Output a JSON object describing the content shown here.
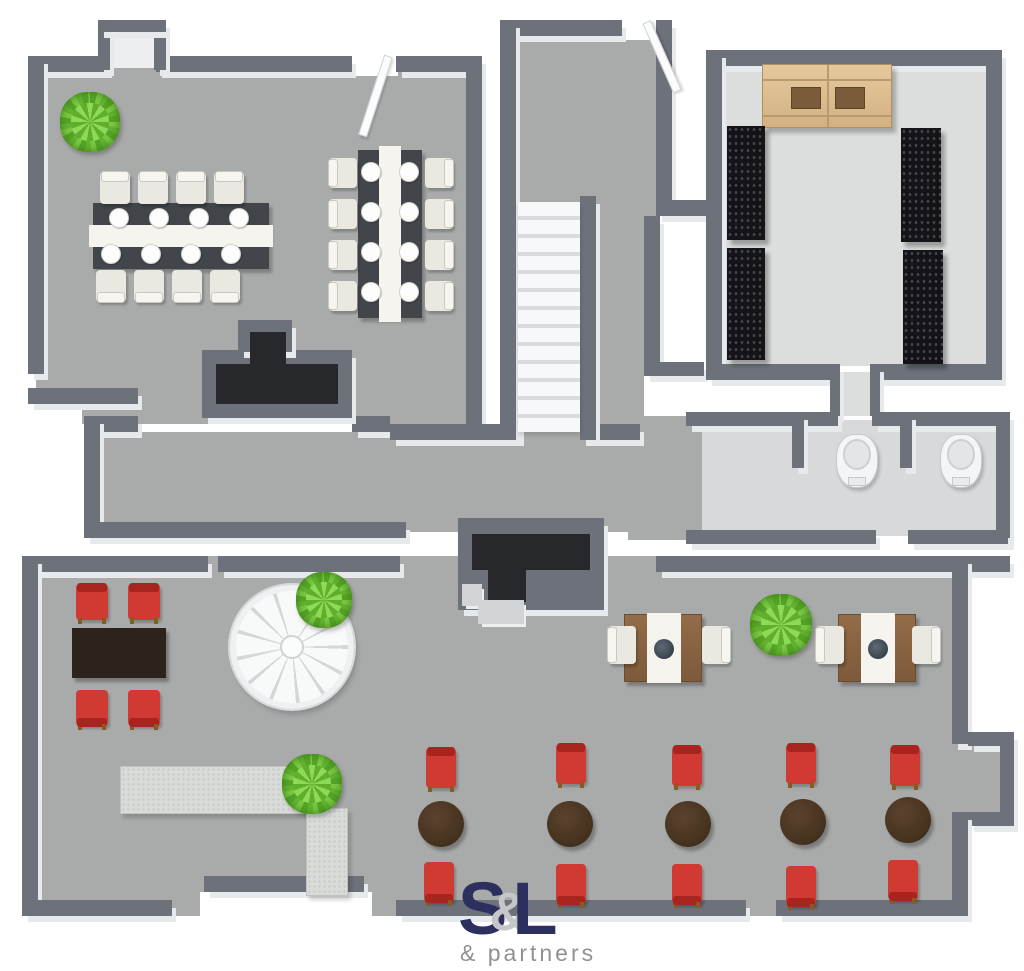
{
  "figure_type": "3d-floor-plan",
  "logo": {
    "letter_s": "S",
    "ampersand": "&",
    "letter_l": "L",
    "subtitle": "& partners"
  },
  "palette": {
    "wall": "#6c717a",
    "wall_side": "#e7eaec",
    "floor_main": "#a9abaa",
    "floor_storage": "#dcdedd",
    "floor_bath": "#d7d9da",
    "floor_alcove": "#eceeef",
    "accent_red": "#d03a32",
    "table_round_brown": "#46331f",
    "table_dark": "#2c231c",
    "wood": "#8b6544",
    "cabinet_wood": "#d9ba8c",
    "rack_black": "#141418",
    "plant_green": "#6dbf36",
    "stair_white": "#f7f8f9",
    "logo_navy": "#2d2f5e",
    "logo_gray": "#8f9193"
  },
  "rooms": [
    {
      "id": "banquet-room",
      "position": "top-left"
    },
    {
      "id": "entry-hall",
      "position": "top-middle"
    },
    {
      "id": "storage-room",
      "position": "top-right"
    },
    {
      "id": "bathrooms",
      "position": "middle-right",
      "toilet_count": 2
    },
    {
      "id": "corridor",
      "position": "middle"
    },
    {
      "id": "restaurant-hall",
      "position": "bottom"
    }
  ],
  "floors": [
    {
      "name": "banquet-room-floor",
      "g": [
        36,
        60,
        442,
        364
      ],
      "c": "#a9abaa"
    },
    {
      "name": "alcove-floor",
      "g": [
        110,
        32,
        44,
        36
      ],
      "c": "#eceeef"
    },
    {
      "name": "entry-hall-floor",
      "g": [
        516,
        28,
        140,
        190
      ],
      "c": "#a9abaa"
    },
    {
      "name": "stair-corridor-floor",
      "g": [
        596,
        196,
        48,
        232
      ],
      "c": "#a9abaa"
    },
    {
      "name": "storage-room-floor",
      "g": [
        714,
        64,
        274,
        302
      ],
      "c": "#dcdedd"
    },
    {
      "name": "storage-passage-floor",
      "g": [
        838,
        372,
        34,
        44
      ],
      "c": "#dcdedd"
    },
    {
      "name": "bathroom-floor",
      "g": [
        692,
        420,
        312,
        116
      ],
      "c": "#d7d9da"
    },
    {
      "name": "corridor-floor",
      "g": [
        92,
        432,
        548,
        100
      ],
      "c": "#a9abaa"
    },
    {
      "name": "link-floor",
      "g": [
        628,
        416,
        74,
        124
      ],
      "c": "#a9abaa"
    },
    {
      "name": "restaurant-hall-floor",
      "g": [
        24,
        556,
        944,
        360
      ],
      "c": "#a9abaa"
    },
    {
      "name": "bay-floor",
      "g": [
        952,
        746,
        48,
        66
      ],
      "c": "#a9abaa"
    }
  ],
  "walls": [
    [
      28,
      56,
      80,
      16
    ],
    [
      156,
      56,
      196,
      16
    ],
    [
      396,
      56,
      86,
      16
    ],
    [
      28,
      56,
      16,
      318
    ],
    [
      28,
      388,
      110,
      16
    ],
    [
      98,
      20,
      12,
      50
    ],
    [
      154,
      20,
      12,
      50
    ],
    [
      98,
      20,
      68,
      12
    ],
    [
      466,
      56,
      16,
      368
    ],
    [
      84,
      416,
      54,
      16
    ],
    [
      84,
      416,
      16,
      122
    ],
    [
      84,
      522,
      322,
      16
    ],
    [
      352,
      416,
      38,
      16
    ],
    [
      390,
      424,
      130,
      16
    ],
    [
      582,
      424,
      58,
      16
    ],
    [
      500,
      20,
      122,
      16
    ],
    [
      500,
      20,
      16,
      420
    ],
    [
      656,
      20,
      16,
      196
    ],
    [
      656,
      200,
      56,
      16
    ],
    [
      580,
      196,
      16,
      244
    ],
    [
      644,
      216,
      16,
      146
    ],
    [
      644,
      362,
      60,
      14
    ],
    [
      706,
      50,
      296,
      16
    ],
    [
      706,
      50,
      16,
      314
    ],
    [
      986,
      50,
      16,
      330
    ],
    [
      706,
      364,
      130,
      16
    ],
    [
      870,
      364,
      132,
      16
    ],
    [
      830,
      364,
      10,
      52
    ],
    [
      870,
      364,
      10,
      52
    ],
    [
      686,
      412,
      152,
      14
    ],
    [
      872,
      412,
      138,
      14
    ],
    [
      996,
      412,
      14,
      132
    ],
    [
      686,
      530,
      190,
      14
    ],
    [
      908,
      530,
      100,
      14
    ],
    [
      792,
      412,
      12,
      56
    ],
    [
      900,
      412,
      12,
      56
    ],
    [
      22,
      556,
      186,
      16
    ],
    [
      218,
      556,
      182,
      16
    ],
    [
      656,
      556,
      354,
      16
    ],
    [
      22,
      556,
      16,
      360
    ],
    [
      22,
      900,
      150,
      16
    ],
    [
      204,
      876,
      160,
      16
    ],
    [
      396,
      900,
      350,
      16
    ],
    [
      776,
      900,
      186,
      16
    ],
    [
      952,
      556,
      16,
      188
    ],
    [
      968,
      732,
      46,
      14
    ],
    [
      1000,
      732,
      14,
      94
    ],
    [
      968,
      812,
      46,
      14
    ],
    [
      952,
      812,
      16,
      104
    ]
  ],
  "white_patches": [
    [
      350,
      50,
      48,
      26
    ],
    [
      620,
      16,
      40,
      24
    ],
    [
      24,
      398,
      58,
      32
    ],
    [
      200,
      892,
      172,
      26
    ]
  ],
  "shafts": [
    {
      "name": "upper-shaft",
      "outer": [
        202,
        350,
        150,
        68
      ],
      "bump": [
        238,
        320,
        54,
        32
      ],
      "voids": [
        [
          250,
          332,
          36,
          46
        ],
        [
          216,
          364,
          122,
          40
        ]
      ],
      "stubs": []
    },
    {
      "name": "lower-shaft",
      "outer": [
        458,
        518,
        146,
        92
      ],
      "voids": [
        [
          472,
          534,
          118,
          36
        ],
        [
          488,
          570,
          38,
          32
        ]
      ],
      "stubs": [
        [
          462,
          584,
          20,
          22
        ],
        [
          478,
          600,
          46,
          24
        ]
      ]
    }
  ],
  "doors": [
    {
      "x": 384,
      "y": 56,
      "len": 84,
      "angle": 18
    },
    {
      "x": 642,
      "y": 22,
      "len": 76,
      "angle": -24
    }
  ],
  "staircase": {
    "g": [
      518,
      202,
      62,
      230
    ],
    "steps": 13
  },
  "spiral_staircase": {
    "cx": 292,
    "cy": 647,
    "r": 62
  },
  "furniture": [
    {
      "t": "banquet-h",
      "g": [
        93,
        203,
        176,
        66
      ],
      "plates_per_side": 4
    },
    {
      "t": "banquet-v",
      "g": [
        358,
        150,
        64,
        168
      ],
      "plates_per_side": 4
    },
    {
      "t": "chair",
      "kind": "white",
      "back": "top",
      "g": [
        100,
        172,
        30,
        32
      ]
    },
    {
      "t": "chair",
      "kind": "white",
      "back": "top",
      "g": [
        138,
        172,
        30,
        32
      ]
    },
    {
      "t": "chair",
      "kind": "white",
      "back": "top",
      "g": [
        176,
        172,
        30,
        32
      ]
    },
    {
      "t": "chair",
      "kind": "white",
      "back": "top",
      "g": [
        214,
        172,
        30,
        32
      ]
    },
    {
      "t": "chair",
      "kind": "white",
      "back": "bottom",
      "g": [
        96,
        270,
        30,
        32
      ]
    },
    {
      "t": "chair",
      "kind": "white",
      "back": "bottom",
      "g": [
        134,
        270,
        30,
        32
      ]
    },
    {
      "t": "chair",
      "kind": "white",
      "back": "bottom",
      "g": [
        172,
        270,
        30,
        32
      ]
    },
    {
      "t": "chair",
      "kind": "white",
      "back": "bottom",
      "g": [
        210,
        270,
        30,
        32
      ]
    },
    {
      "t": "chair",
      "kind": "white",
      "back": "left",
      "g": [
        329,
        158,
        28,
        30
      ]
    },
    {
      "t": "chair",
      "kind": "white",
      "back": "left",
      "g": [
        329,
        199,
        28,
        30
      ]
    },
    {
      "t": "chair",
      "kind": "white",
      "back": "left",
      "g": [
        329,
        240,
        28,
        30
      ]
    },
    {
      "t": "chair",
      "kind": "white",
      "back": "left",
      "g": [
        329,
        281,
        28,
        30
      ]
    },
    {
      "t": "chair",
      "kind": "white",
      "back": "right",
      "g": [
        425,
        158,
        28,
        30
      ]
    },
    {
      "t": "chair",
      "kind": "white",
      "back": "right",
      "g": [
        425,
        199,
        28,
        30
      ]
    },
    {
      "t": "chair",
      "kind": "white",
      "back": "right",
      "g": [
        425,
        240,
        28,
        30
      ]
    },
    {
      "t": "chair",
      "kind": "white",
      "back": "right",
      "g": [
        425,
        281,
        28,
        30
      ]
    },
    {
      "t": "cabinet",
      "g": [
        762,
        64,
        130,
        64
      ]
    },
    {
      "t": "rack",
      "g": [
        727,
        126,
        38,
        114
      ]
    },
    {
      "t": "rack",
      "g": [
        727,
        248,
        38,
        112
      ]
    },
    {
      "t": "rack",
      "g": [
        901,
        128,
        40,
        114
      ]
    },
    {
      "t": "rack",
      "g": [
        903,
        250,
        40,
        114
      ]
    },
    {
      "t": "toilet",
      "g": [
        836,
        434,
        42,
        54
      ]
    },
    {
      "t": "toilet",
      "g": [
        940,
        434,
        42,
        54
      ]
    },
    {
      "t": "table-dark",
      "g": [
        72,
        628,
        94,
        50
      ]
    },
    {
      "t": "chair",
      "kind": "red",
      "back": "top",
      "g": [
        76,
        584,
        32,
        36
      ]
    },
    {
      "t": "chair",
      "kind": "red",
      "back": "top",
      "g": [
        128,
        584,
        32,
        36
      ]
    },
    {
      "t": "chair",
      "kind": "red",
      "back": "bottom",
      "g": [
        76,
        690,
        32,
        36
      ]
    },
    {
      "t": "chair",
      "kind": "red",
      "back": "bottom",
      "g": [
        128,
        690,
        32,
        36
      ]
    },
    {
      "t": "counter",
      "g": [
        120,
        766,
        190,
        48
      ]
    },
    {
      "t": "counter",
      "g": [
        306,
        808,
        42,
        88
      ]
    },
    {
      "t": "table-wood",
      "g": [
        624,
        614,
        78,
        68
      ]
    },
    {
      "t": "chair",
      "kind": "white",
      "back": "left",
      "g": [
        608,
        626,
        28,
        38
      ]
    },
    {
      "t": "chair",
      "kind": "white",
      "back": "right",
      "g": [
        702,
        626,
        28,
        38
      ]
    },
    {
      "t": "table-wood",
      "g": [
        838,
        614,
        78,
        68
      ]
    },
    {
      "t": "chair",
      "kind": "white",
      "back": "left",
      "g": [
        816,
        626,
        28,
        38
      ]
    },
    {
      "t": "chair",
      "kind": "white",
      "back": "right",
      "g": [
        912,
        626,
        28,
        38
      ]
    },
    {
      "t": "table-round",
      "g": [
        418,
        801,
        46,
        46
      ]
    },
    {
      "t": "table-round",
      "g": [
        547,
        801,
        46,
        46
      ]
    },
    {
      "t": "table-round",
      "g": [
        665,
        801,
        46,
        46
      ]
    },
    {
      "t": "table-round",
      "g": [
        780,
        799,
        46,
        46
      ]
    },
    {
      "t": "table-round",
      "g": [
        885,
        797,
        46,
        46
      ]
    },
    {
      "t": "chair",
      "kind": "red",
      "back": "top",
      "g": [
        426,
        748,
        30,
        40
      ]
    },
    {
      "t": "chair",
      "kind": "red",
      "back": "top",
      "g": [
        556,
        744,
        30,
        40
      ]
    },
    {
      "t": "chair",
      "kind": "red",
      "back": "top",
      "g": [
        672,
        746,
        30,
        40
      ]
    },
    {
      "t": "chair",
      "kind": "red",
      "back": "top",
      "g": [
        786,
        744,
        30,
        40
      ]
    },
    {
      "t": "chair",
      "kind": "red",
      "back": "top",
      "g": [
        890,
        746,
        30,
        40
      ]
    },
    {
      "t": "chair",
      "kind": "red",
      "back": "bottom",
      "g": [
        424,
        862,
        30,
        40
      ]
    },
    {
      "t": "chair",
      "kind": "red",
      "back": "bottom",
      "g": [
        556,
        864,
        30,
        40
      ]
    },
    {
      "t": "chair",
      "kind": "red",
      "back": "bottom",
      "g": [
        672,
        864,
        30,
        40
      ]
    },
    {
      "t": "chair",
      "kind": "red",
      "back": "bottom",
      "g": [
        786,
        866,
        30,
        40
      ]
    },
    {
      "t": "chair",
      "kind": "red",
      "back": "bottom",
      "g": [
        888,
        860,
        30,
        40
      ]
    },
    {
      "t": "plant",
      "g": [
        60,
        92,
        60,
        60
      ]
    },
    {
      "t": "plant",
      "g": [
        296,
        572,
        56,
        56
      ]
    },
    {
      "t": "plant",
      "g": [
        750,
        594,
        62,
        62
      ]
    },
    {
      "t": "plant",
      "g": [
        282,
        754,
        60,
        60
      ]
    }
  ]
}
